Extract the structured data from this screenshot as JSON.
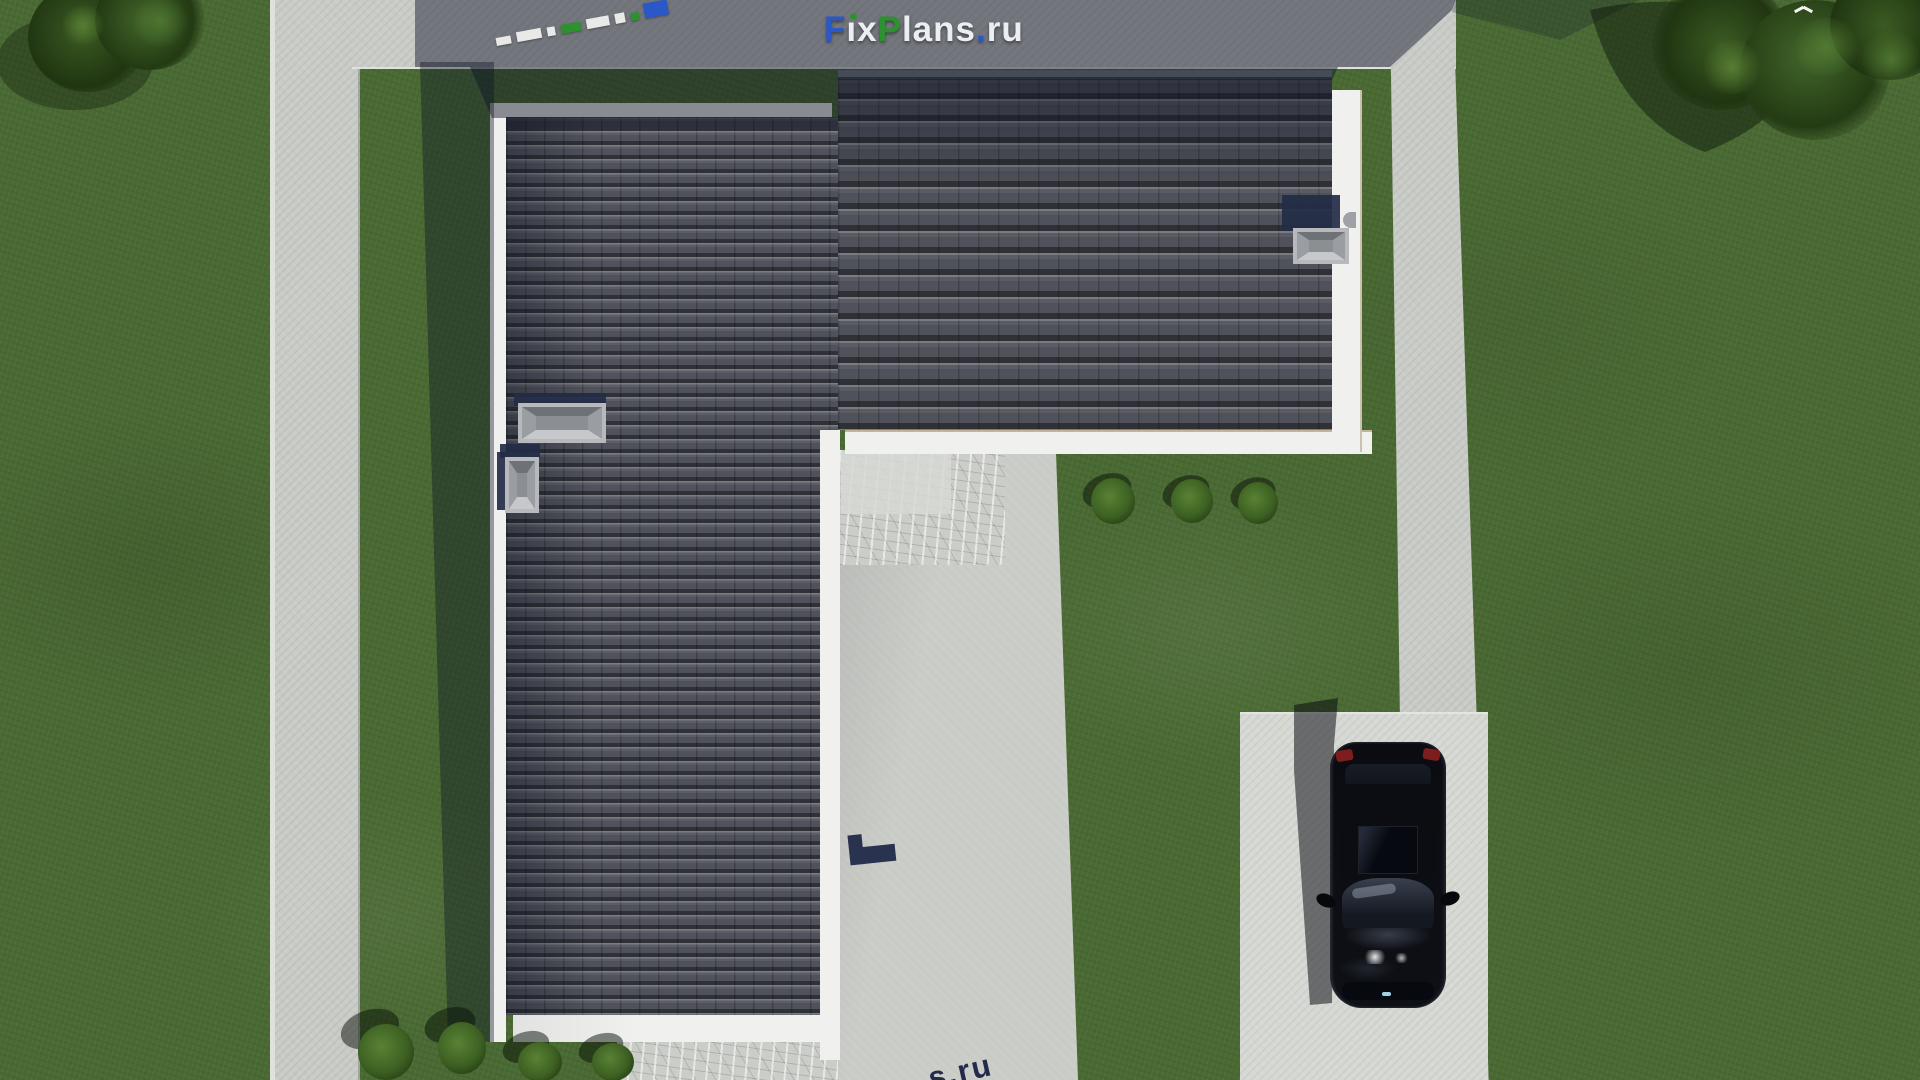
{
  "brand": {
    "name": "FixPlans.ru",
    "letters": [
      {
        "t": "F",
        "style": "color:#2b58c8"
      },
      {
        "t": "ı",
        "style": "color:#eceef1"
      },
      {
        "t": "x",
        "style": "color:#eceef1"
      },
      {
        "t": "P",
        "style": "color:#2e9130"
      },
      {
        "t": "lans",
        "style": "color:#eceef1"
      },
      {
        "t": ".",
        "style": "color:#2b58c8"
      },
      {
        "t": "ru",
        "style": "color:#eceef1"
      }
    ],
    "i_dot_color": "#2e9130"
  },
  "watermarks": {
    "bottom_text": "s.ru",
    "top_blocks": [
      {
        "style": "width:15px;height:8px;background:#e9eae8"
      },
      {
        "style": "width:25px;height:10px;background:#e9eae8"
      },
      {
        "style": "width:8px;height:9px;background:#e9eae8"
      },
      {
        "style": "width:20px;height:9px;background:#2e9130"
      },
      {
        "style": "width:23px;height:10px;background:#e9eae8"
      },
      {
        "style": "width:10px;height:10px;background:#e9eae8"
      },
      {
        "style": "width:8px;height:8px;background:#2e9130"
      },
      {
        "style": "width:24px;height:15px;background:#2b58c8"
      }
    ]
  },
  "palette": {
    "grass": "#4a6a33",
    "grass-dark": "#2c4423",
    "concrete": "#c9cbc7",
    "concrete-bright": "#d6d8d3",
    "shadow-navy": "#0d1326",
    "roof": "#4f525a",
    "roof-gap": "#383b43",
    "fascia": "#f0f1ef",
    "vent-navy": "#232c46",
    "car-black": "#0b0d12",
    "brand-blue": "#2b58c8",
    "brand-green": "#2e9130",
    "watermark-navy": "#222b4a"
  }
}
